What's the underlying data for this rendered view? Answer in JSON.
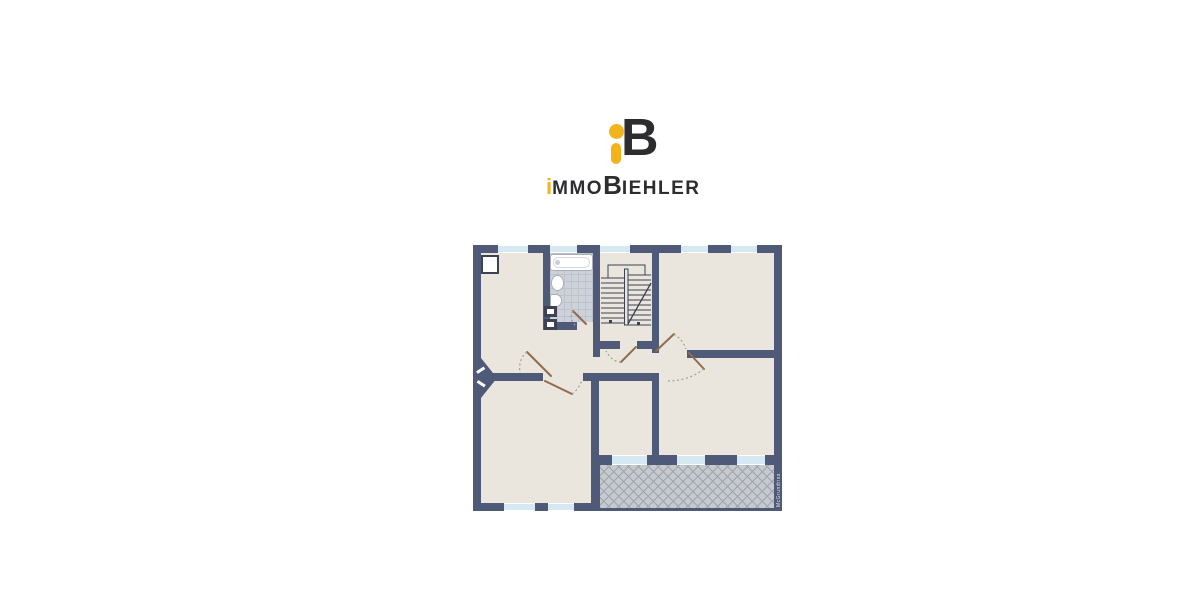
{
  "brand": {
    "name": "immoBiehler",
    "monogram_b": "B",
    "word_parts": [
      "i",
      "MMO",
      "B",
      "IEHLER"
    ],
    "colors": {
      "yellow": "#F2B31D",
      "dark": "#2D2D30"
    }
  },
  "floor_plan": {
    "watermark": "McGrundriss",
    "colors": {
      "wall": "#4E5A77",
      "floor": "#EAE6DD",
      "window": "#D6E9F2",
      "tile": "#CDD1D9",
      "tileLine": "#BDC3CD",
      "balcony": "#C6CACF",
      "hatch": "#9EA4AD",
      "door": "#8F6C4D",
      "dash": "#A89C86",
      "line": "#3C4252"
    },
    "features": [
      "top-left-room",
      "bathroom",
      "staircase",
      "top-right-room",
      "hallway",
      "middle-right-room",
      "lower-left-room",
      "lower-middle-room",
      "balcony-terrace",
      "entrance-door"
    ]
  }
}
